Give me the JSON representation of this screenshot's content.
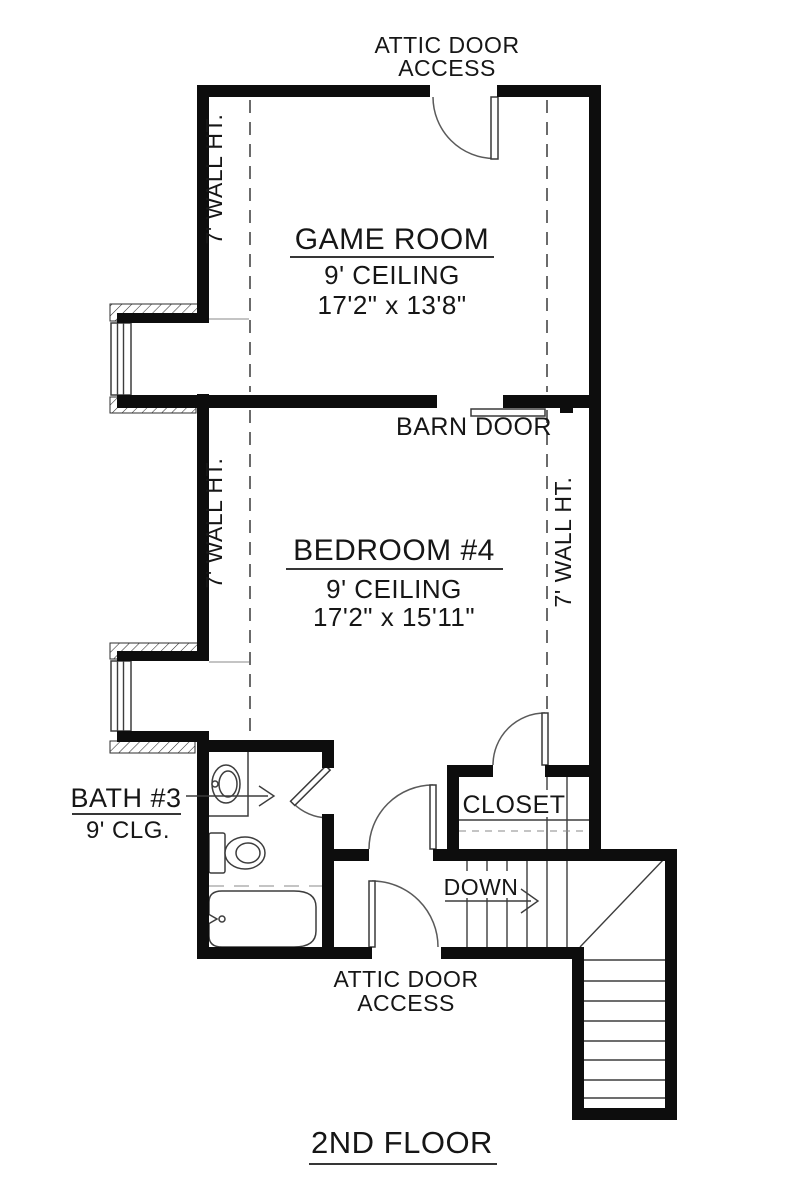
{
  "floor_plan": {
    "title": "2ND FLOOR",
    "rooms": {
      "game_room": {
        "name": "GAME ROOM",
        "ceiling": "9' CEILING",
        "dimensions": "17'2\" x 13'8\""
      },
      "bedroom_4": {
        "name": "BEDROOM #4",
        "ceiling": "9' CEILING",
        "dimensions": "17'2\" x 15'11\""
      },
      "bath_3": {
        "name": "BATH #3",
        "ceiling": "9' CLG."
      },
      "closet": {
        "name": "CLOSET"
      }
    },
    "annotations": {
      "attic_access_top": {
        "line1": "ATTIC DOOR",
        "line2": "ACCESS"
      },
      "attic_access_bottom": {
        "line1": "ATTIC DOOR",
        "line2": "ACCESS"
      },
      "barn_door": "BARN DOOR",
      "down": "DOWN",
      "wall_height_game_left": "7' WALL HT.",
      "wall_height_bedroom_left": "7' WALL HT.",
      "wall_height_bedroom_right": "7' WALL HT."
    },
    "colors": {
      "walls": "#0d0d0d",
      "thin_lines": "#3d3d3d",
      "dashed_lines": "#6b6b6b",
      "background": "#ffffff"
    }
  }
}
